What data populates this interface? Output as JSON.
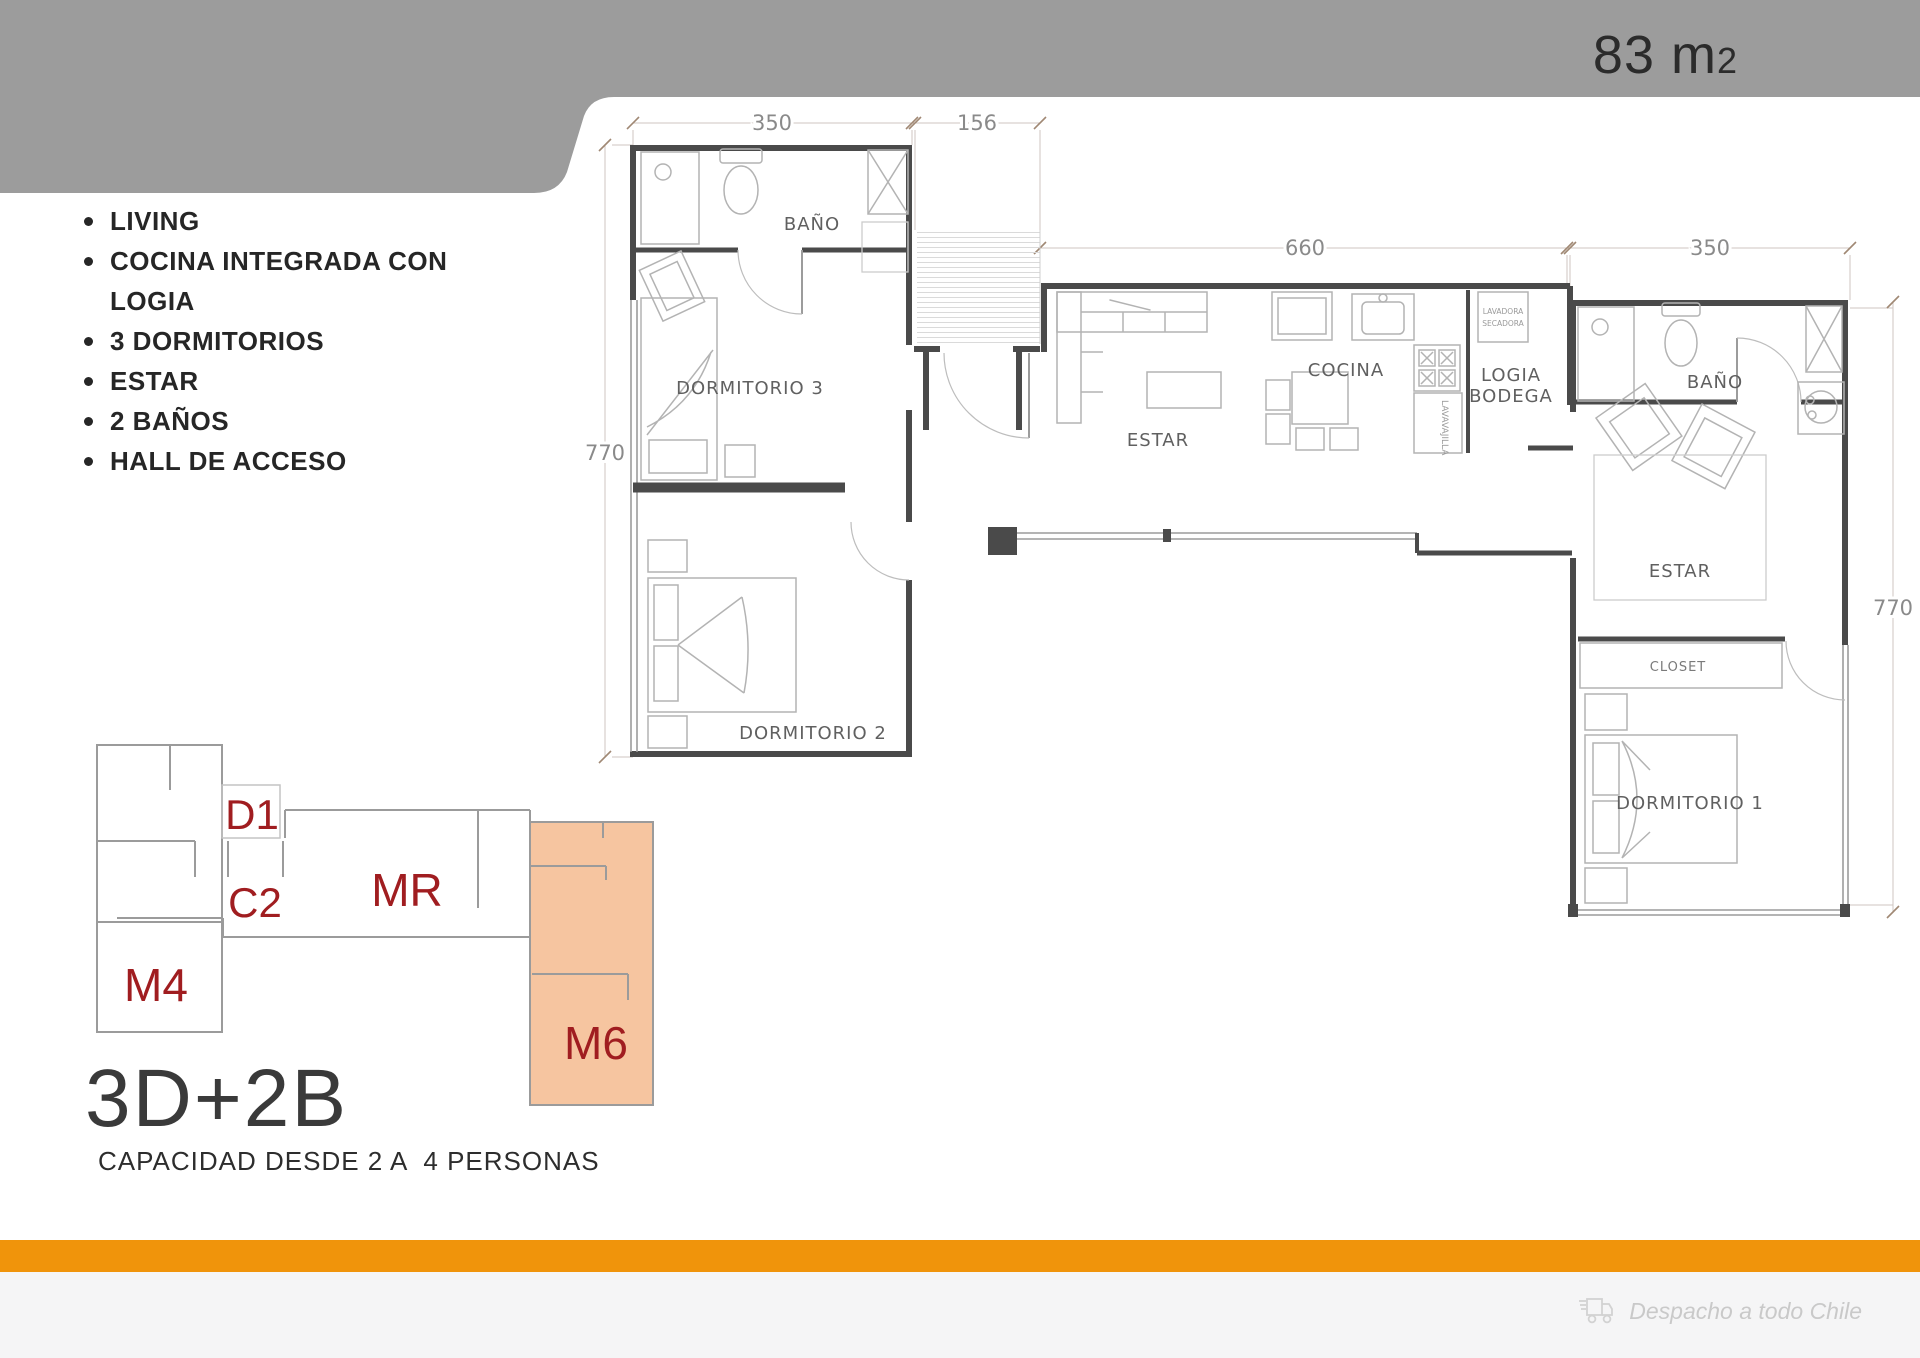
{
  "colors": {
    "header_band": "#9C9C9C",
    "accent_orange": "#F0940B",
    "unit_highlight": "#F6C5A0",
    "unit_label_red": "#A01D20"
  },
  "header": {
    "area_value": "83 m",
    "area_exponent": "2"
  },
  "features": {
    "items": [
      {
        "label": "LIVING"
      },
      {
        "label": "COCINA INTEGRADA CON\nLOGIA"
      },
      {
        "label": "3 DORMITORIOS"
      },
      {
        "label": "ESTAR"
      },
      {
        "label": "2 BAÑOS"
      },
      {
        "label": "HALL DE ACCESO"
      }
    ]
  },
  "floor_plan": {
    "dimensions": {
      "top_left": "350",
      "hall": "156",
      "center": "660",
      "top_right": "350",
      "left_height": "770",
      "right_height": "770"
    },
    "rooms": {
      "bathroom_left": "BAÑO",
      "bedroom3": "DORMITORIO 3",
      "bedroom2": "DORMITORIO 2",
      "living_center": "ESTAR",
      "kitchen": "COCINA",
      "logia_line1": "LOGIA",
      "logia_line2": "BODEGA",
      "bathroom_right": "BAÑO",
      "living_right": "ESTAR",
      "closet": "CLOSET",
      "bedroom1": "DORMITORIO 1"
    },
    "appliances": {
      "dishwasher": "LAVAVAJILLA",
      "washer_line1": "LAVADORA",
      "washer_line2": "SECADORA"
    }
  },
  "key_plan": {
    "units": [
      {
        "id": "D1",
        "highlighted": false
      },
      {
        "id": "C2",
        "highlighted": false
      },
      {
        "id": "MR",
        "highlighted": false
      },
      {
        "id": "M4",
        "highlighted": false
      },
      {
        "id": "M6",
        "highlighted": true
      }
    ]
  },
  "summary": {
    "typology": "3D+2B",
    "capacity": "CAPACIDAD DESDE 2 A  4 PERSONAS"
  },
  "footer": {
    "shipping_note": "Despacho a todo Chile"
  }
}
